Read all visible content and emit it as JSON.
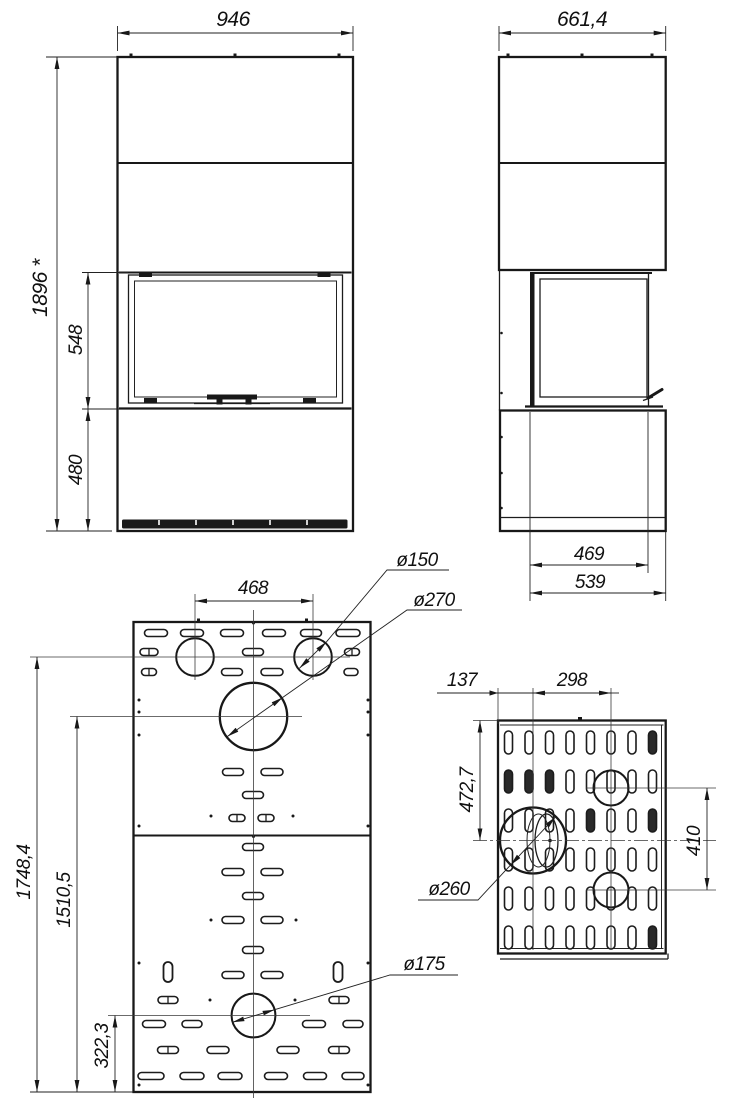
{
  "drawing": {
    "front_view": {
      "width": "946",
      "overall_height": "1896 *",
      "glass_height": "548",
      "base_height": "480"
    },
    "side_view": {
      "depth": "661,4",
      "inner_depth": "469",
      "base_depth": "539"
    },
    "rear_panel": {
      "flue_spacing": "468",
      "flue_diameter": "ø150",
      "outlet_diameter": "ø270",
      "height_to_flues": "1748,4",
      "height_to_outlet": "1510,5",
      "height_to_lower_hole": "322,3",
      "lower_hole_diameter": "ø175"
    },
    "side_panel": {
      "edge_offset": "137",
      "hole_spacing": "298",
      "top_to_outlet": "472,7",
      "hole_vertical_spacing": "410",
      "outlet_diameter": "ø260"
    }
  }
}
